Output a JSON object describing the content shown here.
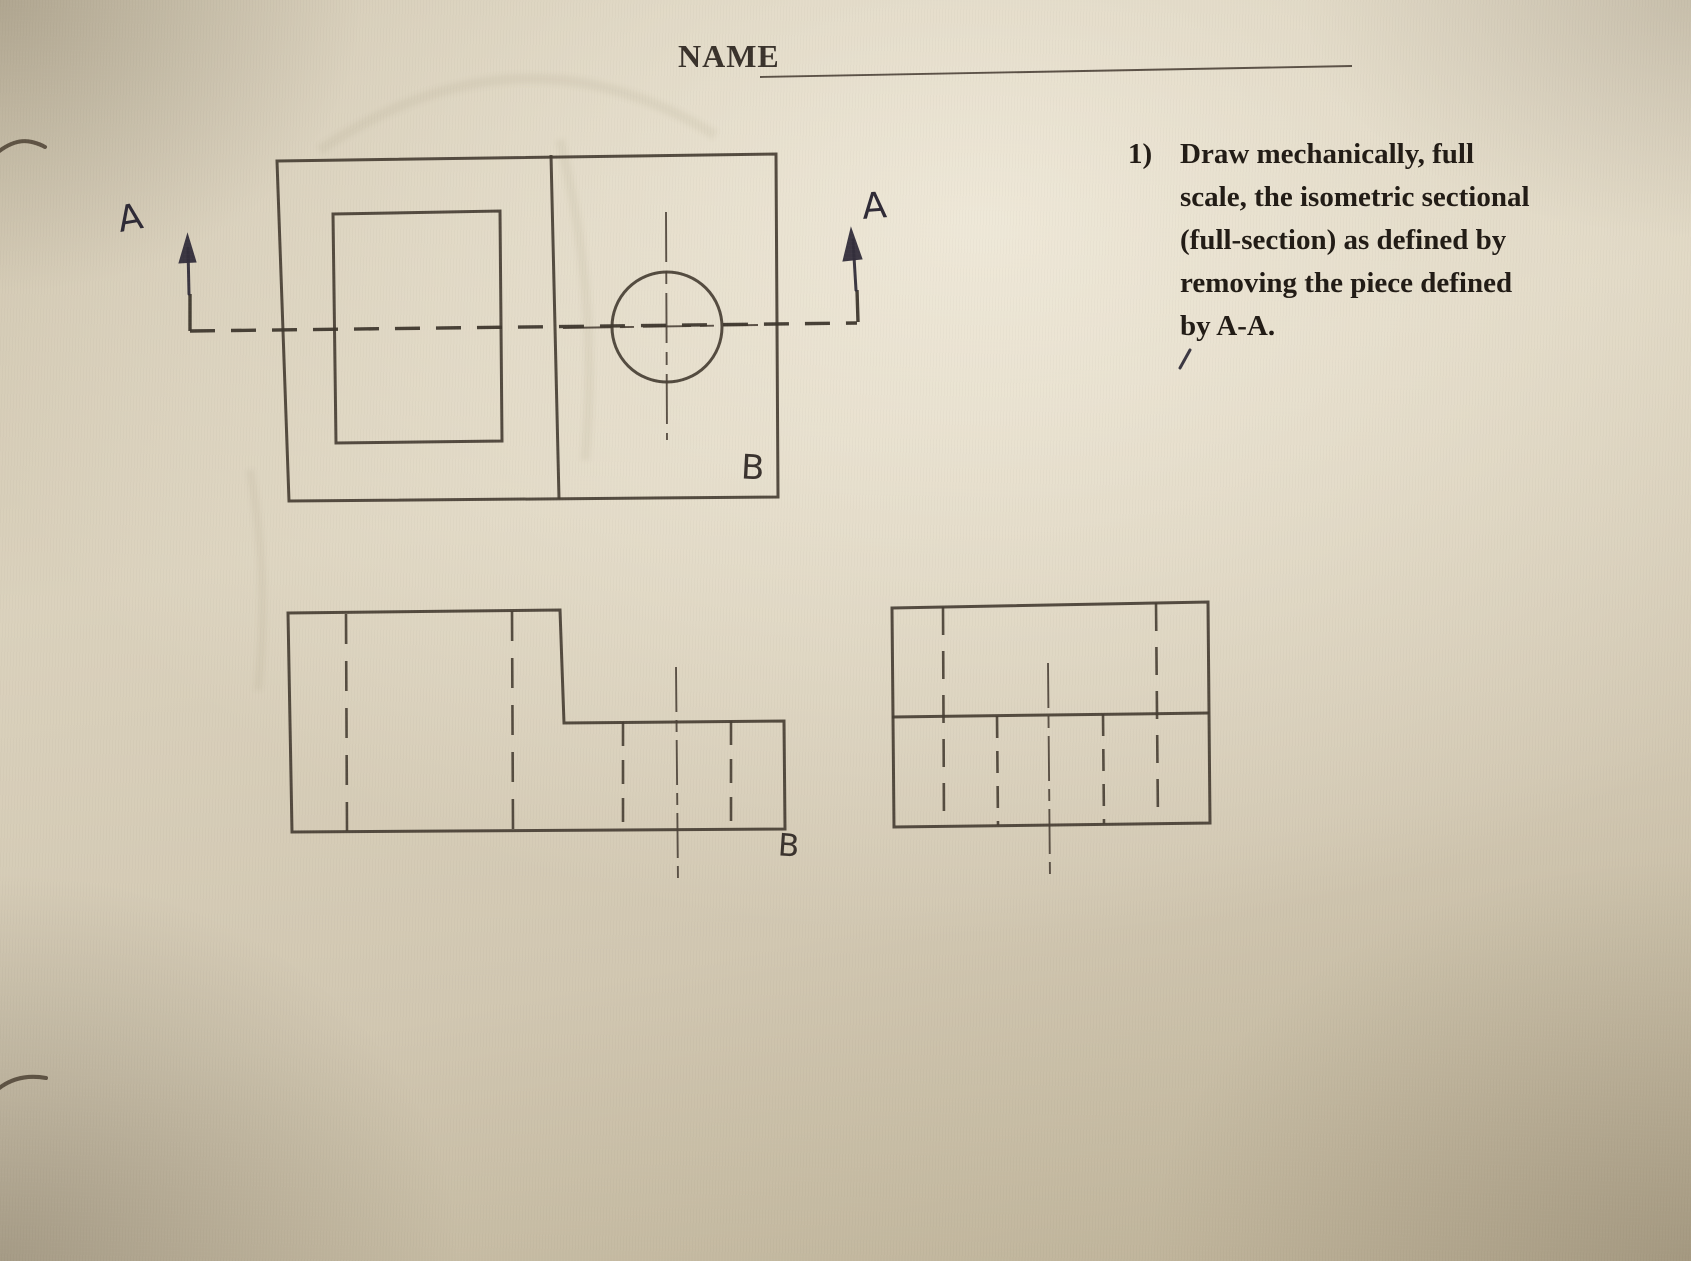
{
  "header": {
    "name_label": "NAME"
  },
  "question": {
    "number": "1)",
    "lines": [
      "Draw mechanically, full",
      "scale, the isometric sectional",
      "(full-section) as defined by",
      "removing the piece defined",
      "by A-A."
    ]
  },
  "section_labels": {
    "left_a": "A",
    "right_a": "A"
  },
  "view_labels": {
    "top_view_b": "B",
    "front_view_b": "B"
  },
  "colors": {
    "paper": "#d5cbb5",
    "pencil_line": "#483f34",
    "pen_ink": "#332e3b",
    "print_ink": "#27211b"
  }
}
